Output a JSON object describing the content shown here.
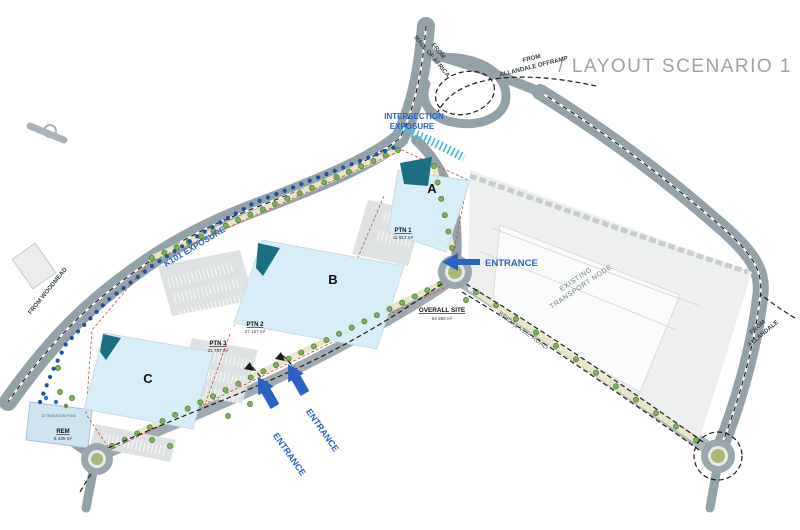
{
  "title": "/ LAYOUT SCENARIO 1",
  "colors": {
    "accent_blue": "#2b62c4",
    "exposure_cyan": "#3cb9dc",
    "road_gray": "#93a1a8",
    "building_blue": "#d9edf7",
    "canopy_teal": "#1c6f82",
    "boundary_red": "#c84a3d",
    "landscape_yellow": "#e9e6c7",
    "title_gray": "#9ba3a9"
  },
  "buildings": [
    {
      "label": "A"
    },
    {
      "label": "B"
    },
    {
      "label": "C"
    }
  ],
  "parcels": [
    {
      "name": "PTN 1",
      "area": "11 617 m²"
    },
    {
      "name": "PTN 2",
      "area": "27 127 m²"
    },
    {
      "name": "PTN 3",
      "area": "21 787 m²"
    },
    {
      "name": "OVERALL SITE",
      "area": "64 360 m²"
    },
    {
      "name": "REM",
      "area": "8 435 m²"
    }
  ],
  "road_labels": {
    "from_mall": [
      "FROM",
      "MALL OF AFRICA"
    ],
    "from_allandale_offramp": [
      "FROM",
      "ALLANDALE OFFRAMP"
    ],
    "from_allandale": [
      "FROM",
      "ALLANDALE"
    ],
    "from_woodmead": "FROM WOODMEAD",
    "bridal_veil": "BRIDAL VEIL ROAD"
  },
  "annotations": {
    "intersection_exposure": [
      "INTERSECTION",
      "EXPOSURE"
    ],
    "k101_exposure": "K101 EXPOSURE",
    "existing_transport_node": [
      "EXISTING",
      "TRANSPORT NODE"
    ],
    "entrance": "ENTRANCE",
    "attenuation_pond": "ATTENUATION POND"
  }
}
